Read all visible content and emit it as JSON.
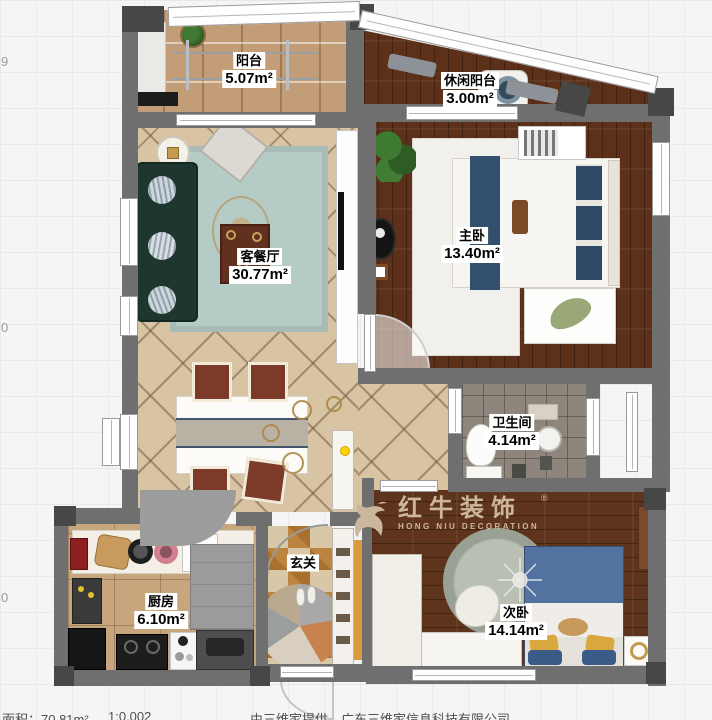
{
  "canvas": {
    "width": 712,
    "height": 720
  },
  "rooms": [
    {
      "id": "balcony",
      "name": "阳台",
      "area": "5.07m²"
    },
    {
      "id": "leisure-balcony",
      "name": "休闲阳台",
      "area": "3.00m²"
    },
    {
      "id": "master-bedroom",
      "name": "主卧",
      "area": "13.40m²"
    },
    {
      "id": "living-dining",
      "name": "客餐厅",
      "area": "30.77m²"
    },
    {
      "id": "bathroom",
      "name": "卫生间",
      "area": "4.14m²"
    },
    {
      "id": "kitchen",
      "name": "厨房",
      "area": "6.10m²"
    },
    {
      "id": "entry",
      "name": "玄关",
      "area": ""
    },
    {
      "id": "second-bedroom",
      "name": "次卧",
      "area": "14.14m²"
    }
  ],
  "watermark": {
    "brand": "红牛装饰",
    "brand_en": "HONG NIU DECORATION",
    "registered": "®"
  },
  "left_ruler": [
    "9",
    "0",
    "0"
  ],
  "footer": {
    "area_total": "面积：70.81m²",
    "scale": "1:0.002",
    "credit": "由三维家提供，广东三维家信息科技有限公司"
  },
  "colors": {
    "wall": "#6f6f6f",
    "wood_floor": "#5d3119",
    "logo_text": "#cdb79c",
    "bed_blue": "#5272a0",
    "sofa_green": "#1d372e"
  }
}
